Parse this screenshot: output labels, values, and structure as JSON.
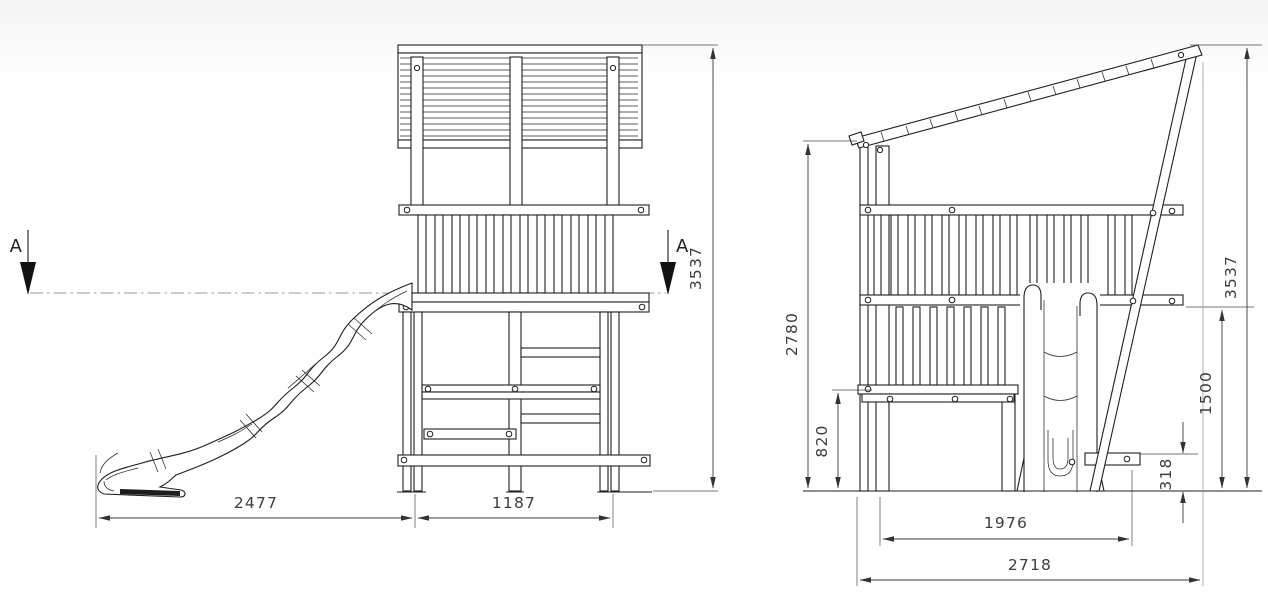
{
  "drawing": {
    "kind": "technical-elevation-drawing",
    "subject": "wooden play tower with wave slide",
    "section": {
      "label": "A"
    },
    "colors": {
      "line": "#1e1e1e",
      "dimension": "#3a3a3a",
      "centerline": "#9a9a9a",
      "background": "#ffffff"
    },
    "front_view": {
      "name": "front elevation",
      "dim_slide_reach": "2477",
      "dim_tower_width": "1187",
      "dim_total_height": "3537"
    },
    "side_view": {
      "name": "side elevation",
      "dim_wall_height": "2780",
      "dim_platform_height": "820",
      "dim_base_length": "1976",
      "dim_overall_length": "2718",
      "dim_total_height": "3537",
      "dim_handrail_height": "1500",
      "dim_step_height": "318"
    }
  }
}
